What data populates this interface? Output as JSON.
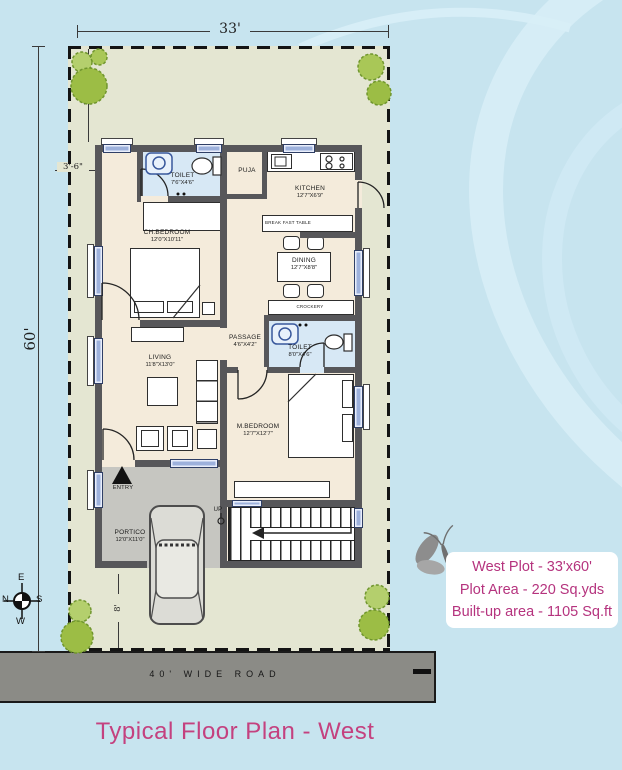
{
  "title": "Typical Floor Plan - West",
  "road": {
    "label": "40' WIDE ROAD"
  },
  "info_box": {
    "line1": "West Plot - 33'x60'",
    "line2": "Plot Area - 220 Sq.yds",
    "line3": "Built-up area - 1105 Sq.ft"
  },
  "dimensions": {
    "plot_width": "33'",
    "plot_height": "60'",
    "front_setback": "10'-3\"",
    "side_setback": "3'-6\"",
    "rear_setback": "8'"
  },
  "compass": {
    "top": "E",
    "left": "N",
    "right": "S",
    "bottom": "W"
  },
  "rooms": {
    "toilet1": {
      "name": "TOILET",
      "size": "7'6\"X4'6\""
    },
    "puja": {
      "name": "PUJA"
    },
    "kitchen": {
      "name": "KITCHEN",
      "size": "12'7\"X6'9\""
    },
    "breakfast_table": {
      "name": "BREAK FAST TABLE"
    },
    "ch_bedroom": {
      "name": "CH.BEDROOM",
      "size": "12'0\"X10'11\""
    },
    "dining": {
      "name": "DINING",
      "size": "12'7\"X8'8\""
    },
    "crockery": {
      "name": "CROCKERY"
    },
    "passage": {
      "name": "PASSAGE",
      "size": "4'6\"X4'2\""
    },
    "toilet2": {
      "name": "TOILET",
      "size": "8'0\"X4'6\""
    },
    "living": {
      "name": "LIVING",
      "size": "11'8\"X13'0\""
    },
    "m_bedroom": {
      "name": "M.BEDROOM",
      "size": "12'7\"X12'7\""
    },
    "portico": {
      "name": "PORTICO",
      "size": "12'0\"X11'0\""
    },
    "entry": {
      "name": "ENTRY"
    },
    "stairs": {
      "name": "UP"
    }
  },
  "colors": {
    "accent_pink": "#c4417f",
    "plot_fill": "#e4e6d2",
    "wall_gray": "#57575a",
    "floor_cream": "#f4ebdb",
    "toilet_blue": "#d7e8f5",
    "road_gray": "#8b8b86",
    "background_blue": "#c7e4ef",
    "tree_green": "#a9c757"
  }
}
